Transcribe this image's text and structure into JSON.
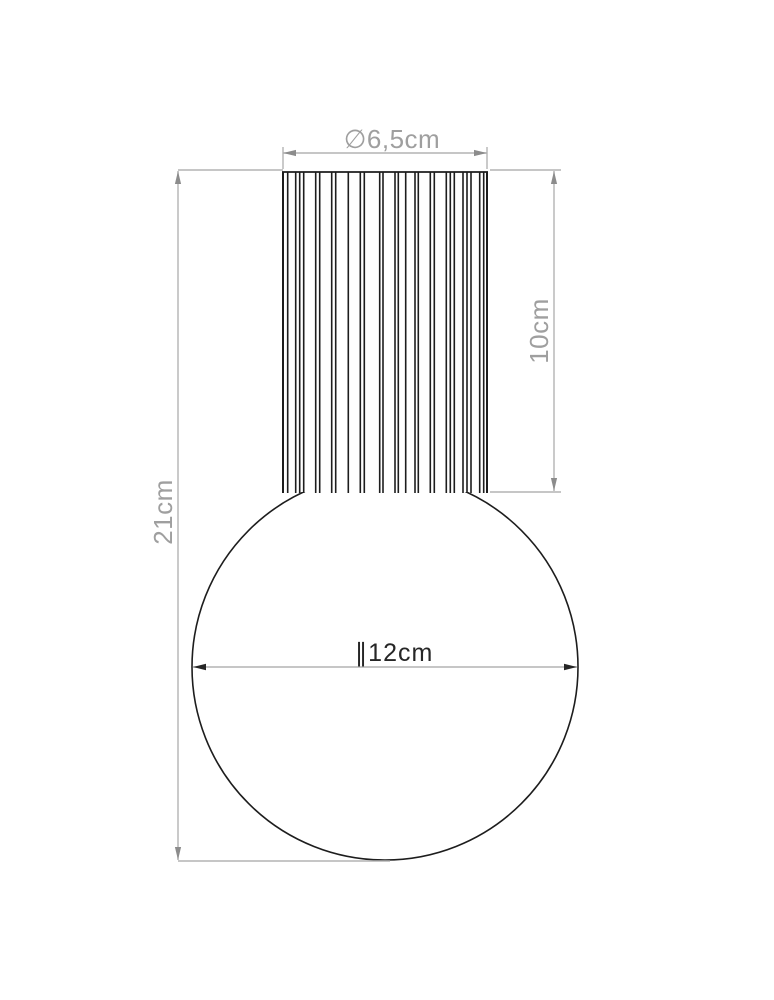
{
  "figure": {
    "type": "technical-dimension-drawing",
    "subject": "lamp with fluted cylindrical cap and spherical glass globe",
    "dimensions": {
      "cap_diameter": "∅6,5cm",
      "cap_height": "10cm",
      "total_height": "21cm",
      "globe_diameter": "∥12cm"
    },
    "colors": {
      "outline": "#1d1d1d",
      "dimension_line": "#b4b4b4",
      "arrow_gray": "#8c8c8c",
      "label_gray": "#9f9f9f",
      "label_dark": "#262626",
      "background": "#ffffff"
    }
  }
}
